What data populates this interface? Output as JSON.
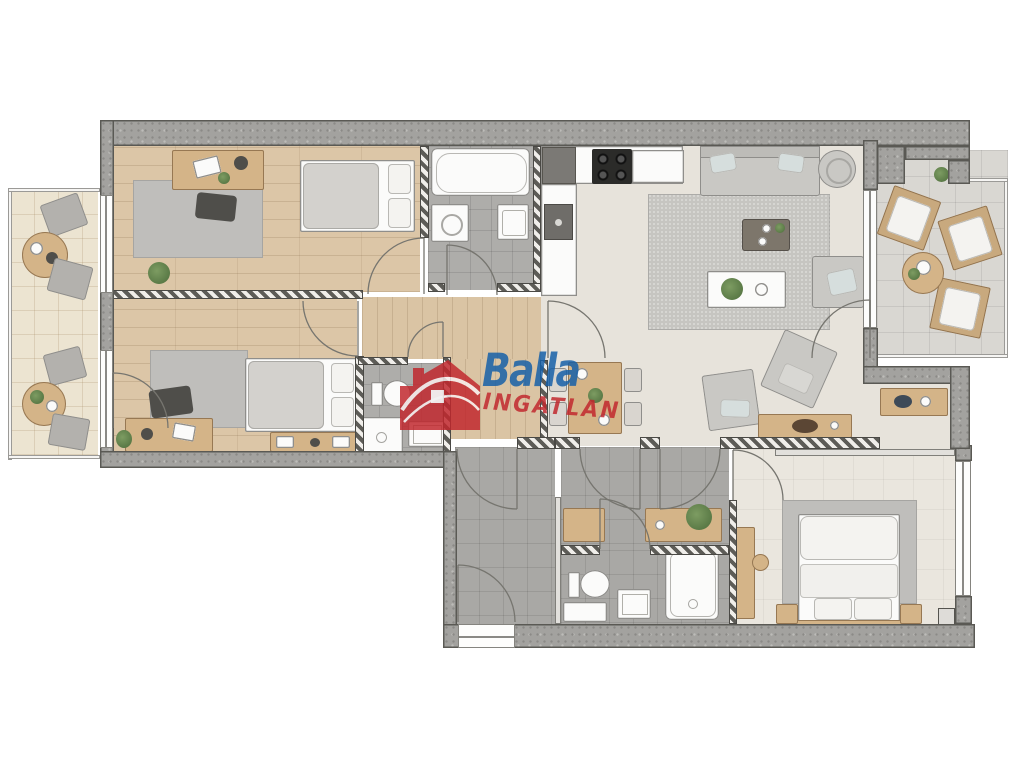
{
  "watermark": {
    "brand": "Balla",
    "subtitle": "INGATLAN",
    "brand_color": "#155fa8",
    "subtitle_color": "#c1272d",
    "house_icon_color": "#c1272d"
  },
  "plan": {
    "type": "apartment-floor-plan-top-view",
    "rooms": [
      {
        "id": "bedroom-1",
        "floor": "wood",
        "furniture": [
          "desk",
          "office-chair",
          "rug",
          "bed",
          "plant"
        ]
      },
      {
        "id": "bedroom-2",
        "floor": "wood",
        "furniture": [
          "desk",
          "office-chair",
          "rug",
          "single-bed",
          "bookshelf",
          "plant"
        ]
      },
      {
        "id": "bathroom-1",
        "floor": "gray-tile",
        "furniture": [
          "bathtub",
          "washing-machine",
          "sink"
        ]
      },
      {
        "id": "wc-shower-room",
        "floor": "gray-tile",
        "furniture": [
          "toilet",
          "shower",
          "sink"
        ]
      },
      {
        "id": "hallway",
        "floor": "wood",
        "furniture": []
      },
      {
        "id": "kitchen",
        "floor": "light-tile",
        "furniture": [
          "counter",
          "cooktop",
          "kitchen-sink",
          "dark-counter"
        ]
      },
      {
        "id": "living-room",
        "floor": "light-tile",
        "furniture": [
          "sofa",
          "round-pouf",
          "coffee-table",
          "white-side-table",
          "armchair",
          "large-rug",
          "white-cabinet"
        ]
      },
      {
        "id": "dining-area",
        "floor": "light-tile",
        "furniture": [
          "dining-table",
          "dining-chair",
          "dining-chair",
          "dining-chair",
          "dining-chair",
          "armchair",
          "armchair",
          "sideboard"
        ]
      },
      {
        "id": "niche",
        "floor": "light-tile",
        "furniture": [
          "console"
        ]
      },
      {
        "id": "entrance-hall",
        "floor": "gray-tile",
        "furniture": []
      },
      {
        "id": "inner-corridor",
        "floor": "gray-tile",
        "furniture": [
          "console",
          "console",
          "plant"
        ]
      },
      {
        "id": "bathroom-2",
        "floor": "gray-tile",
        "furniture": [
          "toilet",
          "sink",
          "shower",
          "cabinet"
        ]
      },
      {
        "id": "bedroom-3",
        "floor": "light-carpet",
        "furniture": [
          "double-bed",
          "nightstand",
          "nightstand",
          "tall-dresser",
          "stool",
          "rug"
        ]
      },
      {
        "id": "balcony-left",
        "floor": "cream-tile",
        "furniture": [
          "round-table",
          "chair",
          "chair",
          "round-table",
          "chair",
          "chair"
        ]
      },
      {
        "id": "terrace-right",
        "floor": "stone-tile",
        "furniture": [
          "lounge-chair",
          "lounge-chair",
          "lounge-chair",
          "round-coffee-table",
          "plant"
        ]
      }
    ]
  },
  "palette": {
    "exterior_wall": "#a3a29f",
    "interior_wall_hatch": "#5d5c57",
    "wood_floor": "#dcc6a7",
    "gray_tile": "#aeadaa",
    "light_tile": "#e7e3db",
    "balcony_tile": "#ece4d1",
    "terrace_tile": "#d9d7d2",
    "rug": "#bfbebb",
    "wood_furniture": "#d4b488",
    "white_fixture": "#fbfbfa"
  }
}
